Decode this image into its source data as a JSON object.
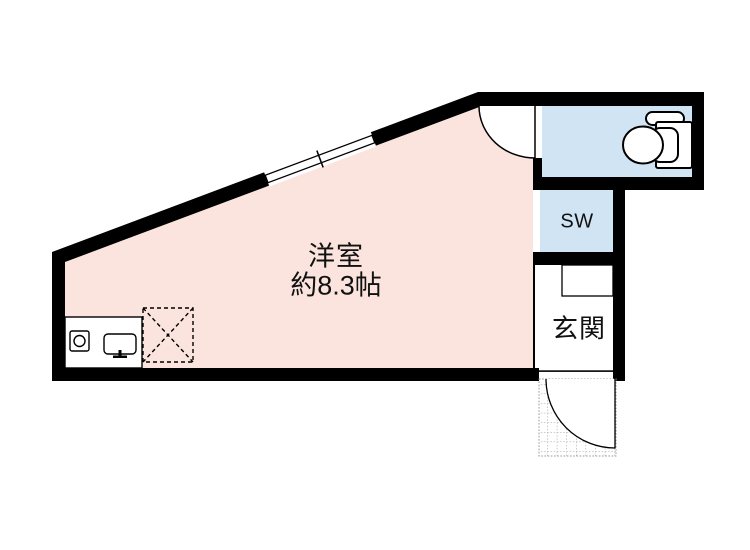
{
  "floorplan": {
    "labels": {
      "main_room_name": "洋室",
      "main_room_size": "約8.3帖",
      "storage": "SW",
      "entrance": "玄関"
    },
    "colors": {
      "wall": "#000000",
      "main_room_fill": "#fbe4dd",
      "wet_area_fill": "#d0e4f4",
      "interior_white": "#ffffff",
      "porch_grid": "#999999",
      "label_text": "#111111"
    },
    "icons": {
      "toilet": "toilet-icon",
      "stove": "stove-burner-icon",
      "sink": "kitchen-sink-icon",
      "window": "sliding-window-icon",
      "door_swings": "door-swing-arc",
      "reserved_space": "dashed-x-box-icon",
      "porch": "tiled-porch"
    }
  }
}
